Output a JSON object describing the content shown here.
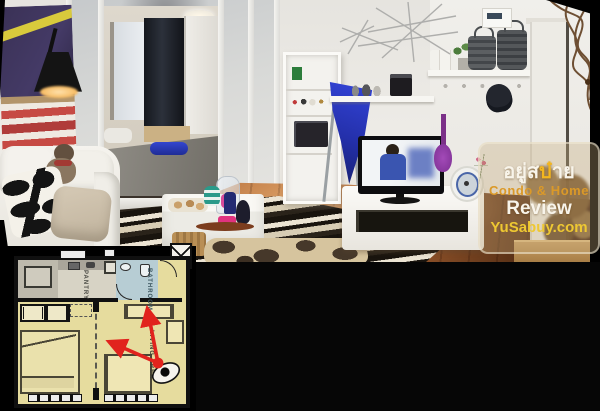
{
  "watermark": {
    "line1_prefix": "อยู่ส",
    "line1_accent": "บ๋",
    "line1_suffix": "าย",
    "line2": "Condo & Home",
    "line3": "Review",
    "line4": "YuSabuy.com",
    "colors": {
      "text": "#f8f4ea",
      "accent": "#f3b61f",
      "condo_home": "#db9928",
      "url": "#eec832",
      "box_fill": "rgba(196,170,122,0.34)",
      "box_border": "rgba(243,235,215,0.55)"
    }
  },
  "floorplan": {
    "labels": {
      "pantry": "PANTRY",
      "bathroom": "BATHROOM",
      "living_area": "LIVING AREA"
    },
    "colors": {
      "floor": "#e6dc9e",
      "walls": "#101010",
      "bathroom": "#b7cdd4",
      "pantry": "#d7d3c5",
      "camera_arrows": "#e1231d"
    }
  },
  "photo": {
    "description": "Panoramic photo of a condo interior: white sofa with black-and-white patterned pillow, striped rug, white coffee table with snacks and toys, frosted-glass sliding partition open to a bedroom with gray bed and blue rolled towel, black arc lamp, abstract flag wall art, wall niche shelves, blue cloth on drying rack, flat-screen TV on white low cabinet, purple ukulele, round white fan, wall shelves with plant and wicker lanterns, wire starburst wall art, hanging cap, white door and dried plant at right, black panorama edges"
  }
}
